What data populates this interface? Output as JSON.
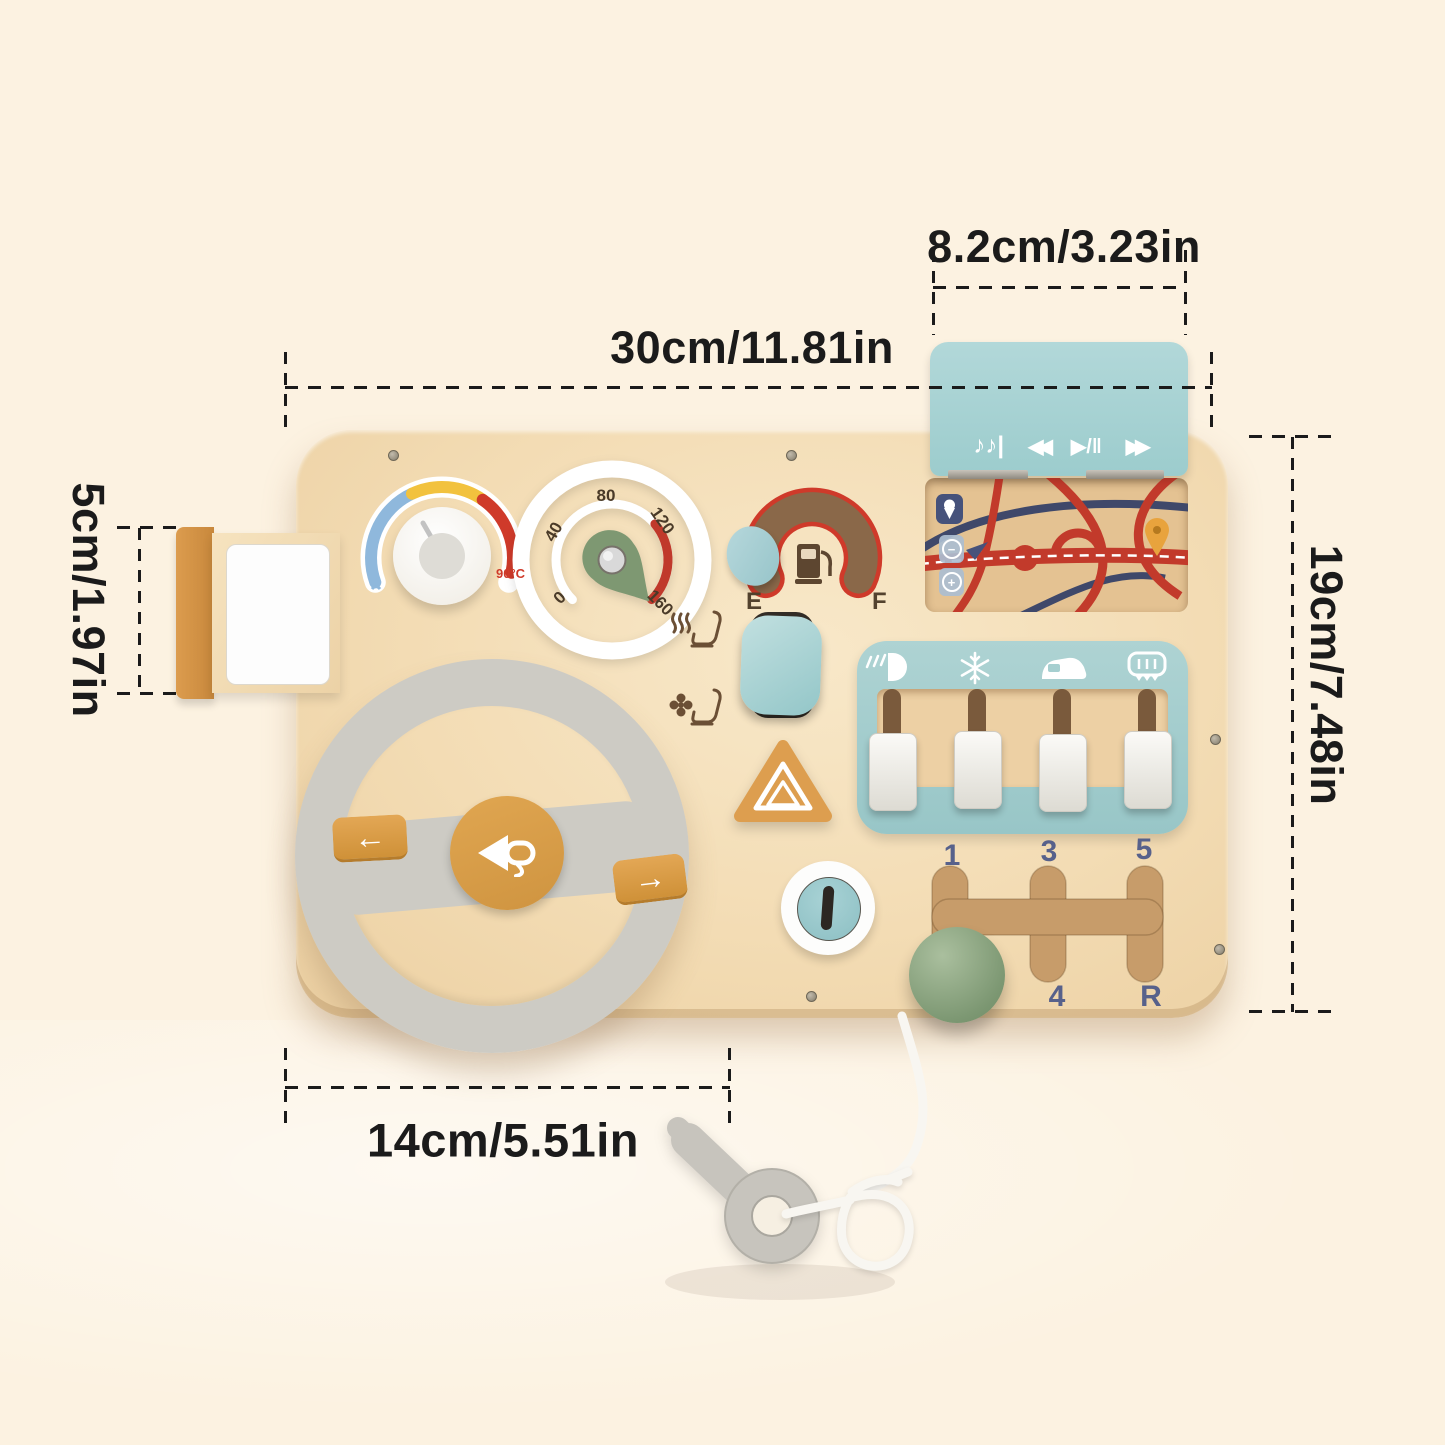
{
  "annotations": {
    "board_width": "30cm/11.81in",
    "player_width": "8.2cm/3.23in",
    "board_height": "19cm/7.48in",
    "mirror_height": "5cm/1.97in",
    "wheel_width": "14cm/5.51in"
  },
  "dashboard": {
    "temperature_gauge": {
      "max_label": "90°C"
    },
    "speedometer": {
      "ticks": [
        "0",
        "40",
        "80",
        "120",
        "160"
      ]
    },
    "fuel_gauge": {
      "empty": "E",
      "full": "F"
    },
    "media_player": {
      "music": "♪♪|",
      "rewind": "◀◀",
      "play_pause": "▶/‖",
      "forward": "▶▶"
    },
    "turn_signals": {
      "left": "←",
      "right": "→"
    },
    "map": {
      "zoom_out": "−",
      "zoom_in": "+"
    },
    "gear_shifter": {
      "top": [
        "1",
        "3",
        "5"
      ],
      "bottom": [
        "4",
        "R"
      ]
    },
    "climate": {
      "icons": [
        "headlight",
        "snowflake",
        "car-recirculation",
        "rear-defrost"
      ]
    }
  },
  "colors": {
    "background": "#fcf2e1",
    "board_wood": "#f3dcb4",
    "accent_teal": "#a7d2d3",
    "accent_orange": "#dda052",
    "accent_sage": "#91ab85",
    "wheel_gray": "#cdcbc4",
    "label_navy": "#57618b",
    "map_red": "#c23a2b",
    "annotation_black": "#1b1b1b"
  }
}
